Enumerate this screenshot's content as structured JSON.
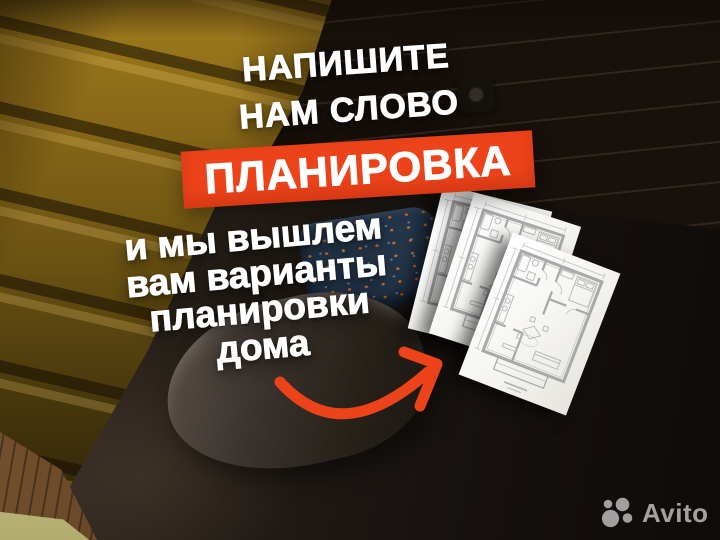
{
  "ad": {
    "headline_line1": "НАПИШИТЕ",
    "headline_line2": "НАМ СЛОВО",
    "keyword": "ПЛАНИРОВКА",
    "body_lines": [
      "и мы вышлем",
      "вам варианты",
      "планировки",
      "дома"
    ],
    "accent_color": "#ec431a",
    "text_color": "#ffffff"
  },
  "watermark": {
    "brand": "Avito",
    "logo_icon": "avito-circles-icon",
    "color": "#d8d8d8"
  },
  "scene": {
    "floorplan_sheet_count": 3,
    "headboard_color": "#8a6a18",
    "wall_color": "#d3cab6",
    "bedding_color": "#1d1611"
  }
}
